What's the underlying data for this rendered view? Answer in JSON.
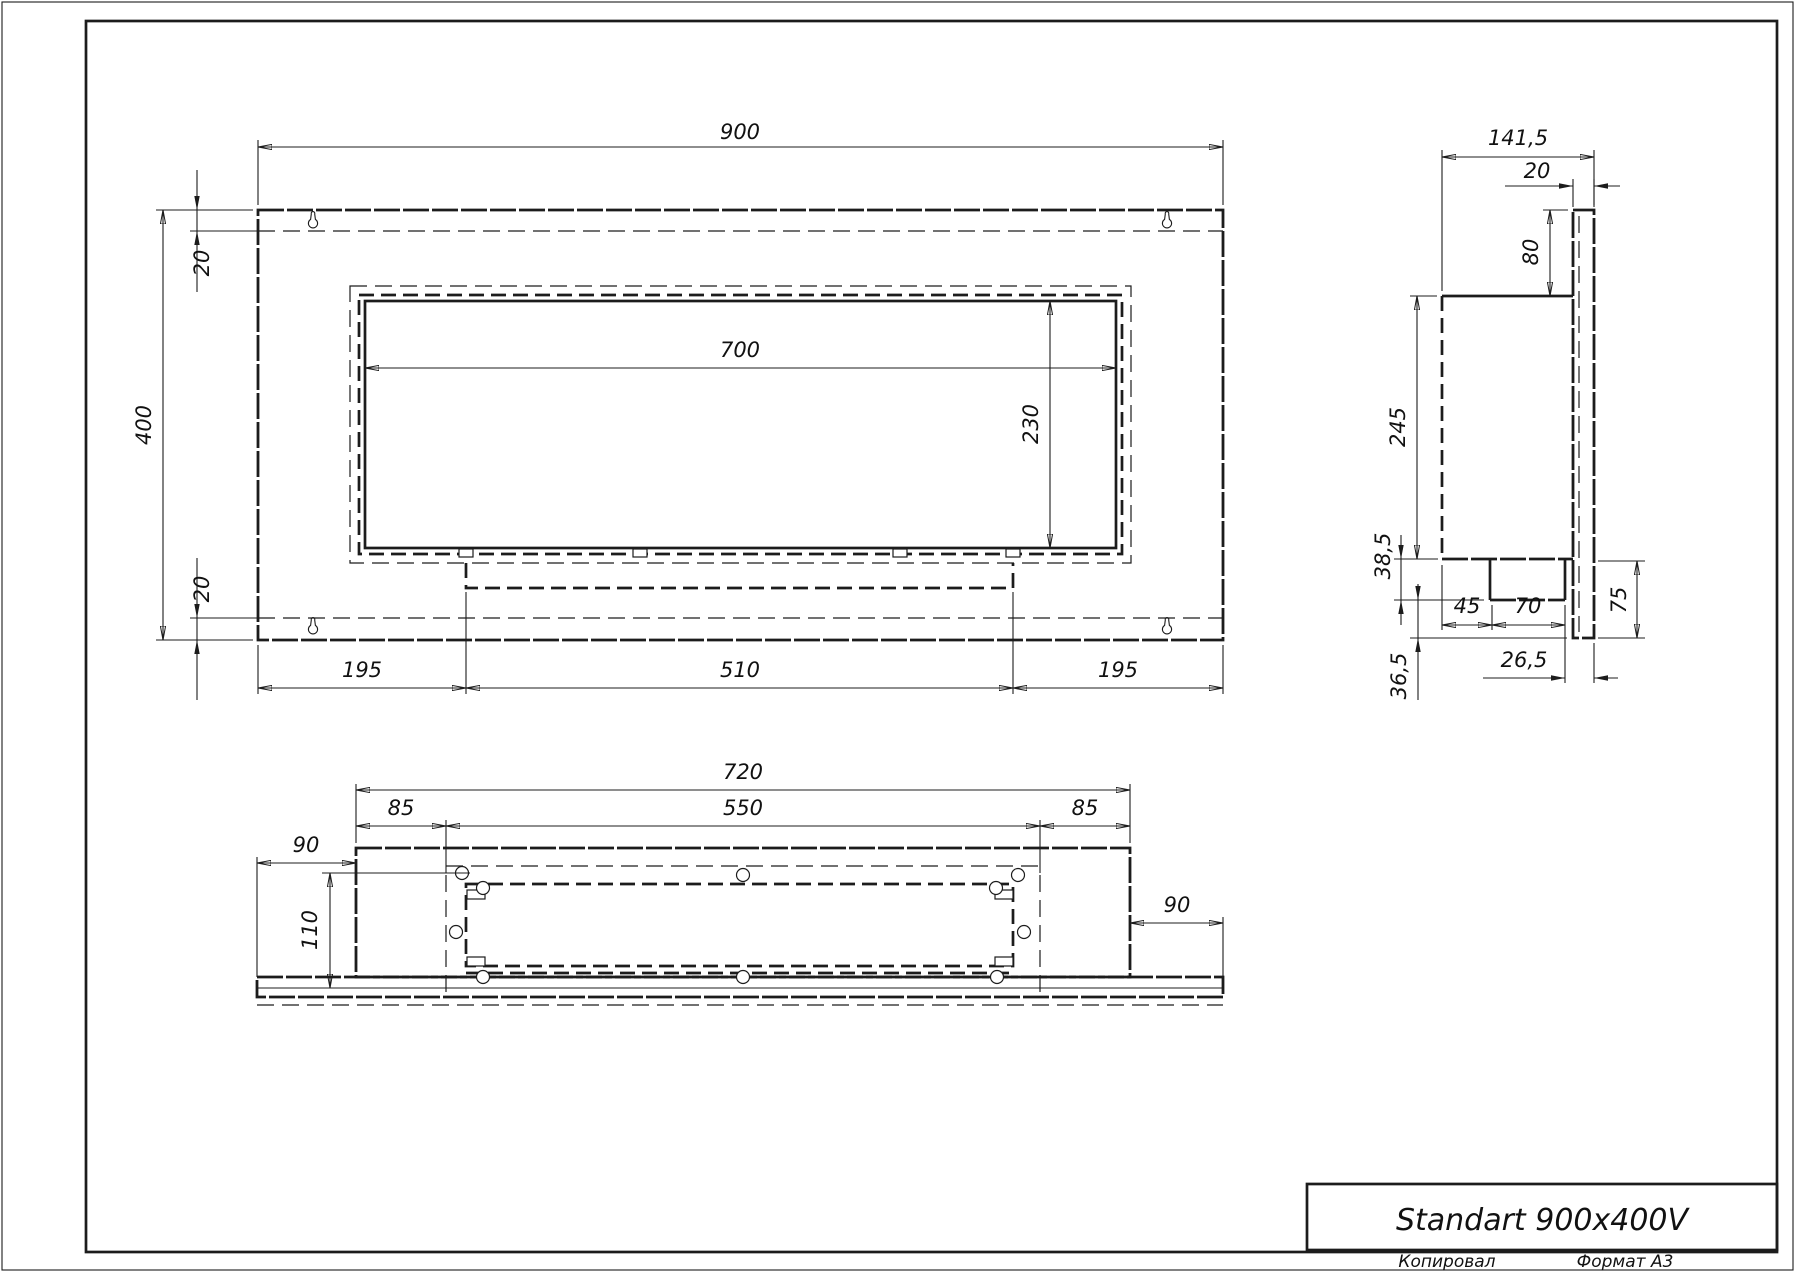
{
  "title_block": {
    "product_name": "Standart 900x400V",
    "copied_label": "Копировал",
    "format_label": "Формат А3"
  },
  "front_view": {
    "dims": {
      "overall_width": "900",
      "overall_height": "400",
      "top_margin": "20",
      "bottom_margin": "20",
      "opening_width": "700",
      "opening_height": "230",
      "bottom_left": "195",
      "bottom_center": "510",
      "bottom_right": "195"
    }
  },
  "side_view": {
    "dims": {
      "overall_depth": "141,5",
      "panel_depth": "20",
      "top_drop": "80",
      "body_height": "245",
      "tray_drop": "38,5",
      "tray_offset": "45",
      "tray_width": "70",
      "tray_gap": "26,5",
      "panel_lower": "75",
      "bottom_gap": "36,5"
    }
  },
  "bottom_view": {
    "dims": {
      "body_width": "720",
      "inset_left": "85",
      "opening_width": "550",
      "inset_right": "85",
      "overhang_left": "90",
      "body_depth": "110",
      "overhang_right": "90"
    }
  }
}
